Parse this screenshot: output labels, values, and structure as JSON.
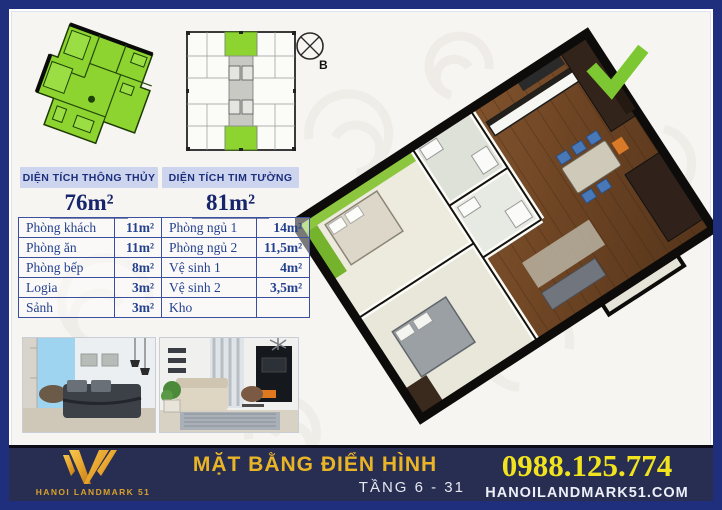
{
  "brand": {
    "name": "HANOI LANDMARK 51",
    "colors": {
      "border_navy": "#202e7e",
      "footer_navy": "#272e52",
      "gold": "#e9b425",
      "phone_yellow": "#f1e31d",
      "highlight_green": "#8dd430",
      "label_bg": "#cdd4ed",
      "table_navy": "#23418f"
    }
  },
  "compass": {
    "label": "B"
  },
  "area_summary": {
    "clear": {
      "label": "DIỆN TÍCH THÔNG THỦY",
      "value": "76m²"
    },
    "wall": {
      "label": "DIỆN TÍCH TIM TƯỜNG",
      "value": "81m²"
    }
  },
  "room_table": {
    "rows": [
      {
        "name_l": "Phòng khách",
        "area_l": "11m²",
        "name_r": "Phòng ngủ 1",
        "area_r": "14m²"
      },
      {
        "name_l": "Phòng ăn",
        "area_l": "11m²",
        "name_r": "Phòng ngủ 2",
        "area_r": "11,5m²"
      },
      {
        "name_l": "Phòng bếp",
        "area_l": "8m²",
        "name_r": "Vệ sinh 1",
        "area_r": "4m²"
      },
      {
        "name_l": "Logia",
        "area_l": "3m²",
        "name_r": "Vệ sinh 2",
        "area_r": "3,5m²"
      },
      {
        "name_l": "Sảnh",
        "area_l": "3m²",
        "name_r": "Kho",
        "area_r": ""
      }
    ]
  },
  "footer": {
    "logo_text": "HANOI LANDMARK 51",
    "title": "MẶT BẰNG ĐIỂN HÌNH",
    "floors": "TẦNG 6 - 31",
    "phone": "0988.125.774",
    "website": "HANOILANDMARK51.COM"
  }
}
